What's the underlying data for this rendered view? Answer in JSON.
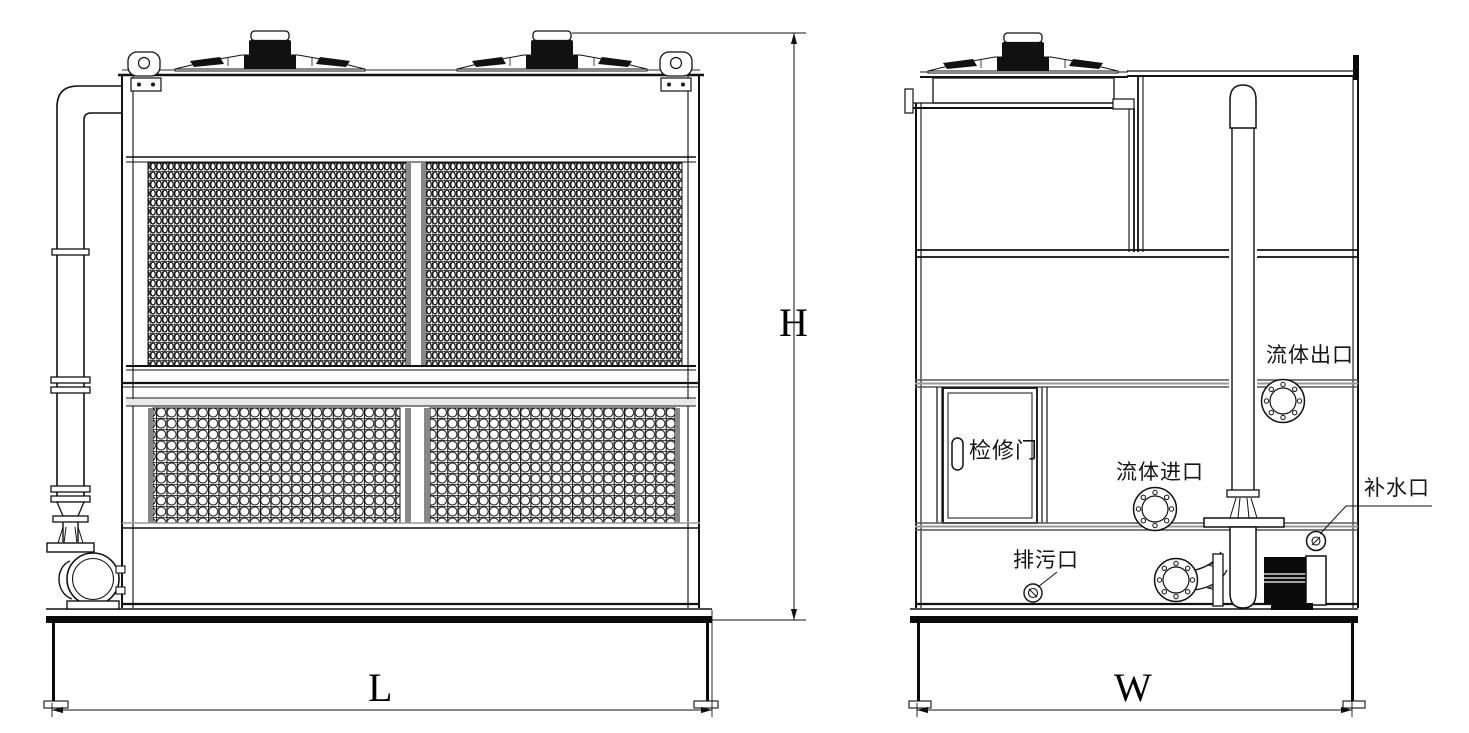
{
  "drawing": {
    "title": "closed circuit cooling tower - general arrangement",
    "views": {
      "front": "front elevation",
      "side": "side elevation"
    }
  },
  "labels": {
    "access_door": "检修门",
    "fluid_outlet": "流体出口",
    "fluid_inlet": "流体进口",
    "drain_port": "排污口",
    "makeup_water_port": "补水口"
  },
  "dimensions": {
    "length": "L",
    "height": "H",
    "width": "W"
  },
  "colors": {
    "line": "#111111",
    "band_gray": "#999999",
    "mesh_mullion_gray": "#888888",
    "rail_black": "#0a0a0a",
    "background": "#ffffff"
  }
}
